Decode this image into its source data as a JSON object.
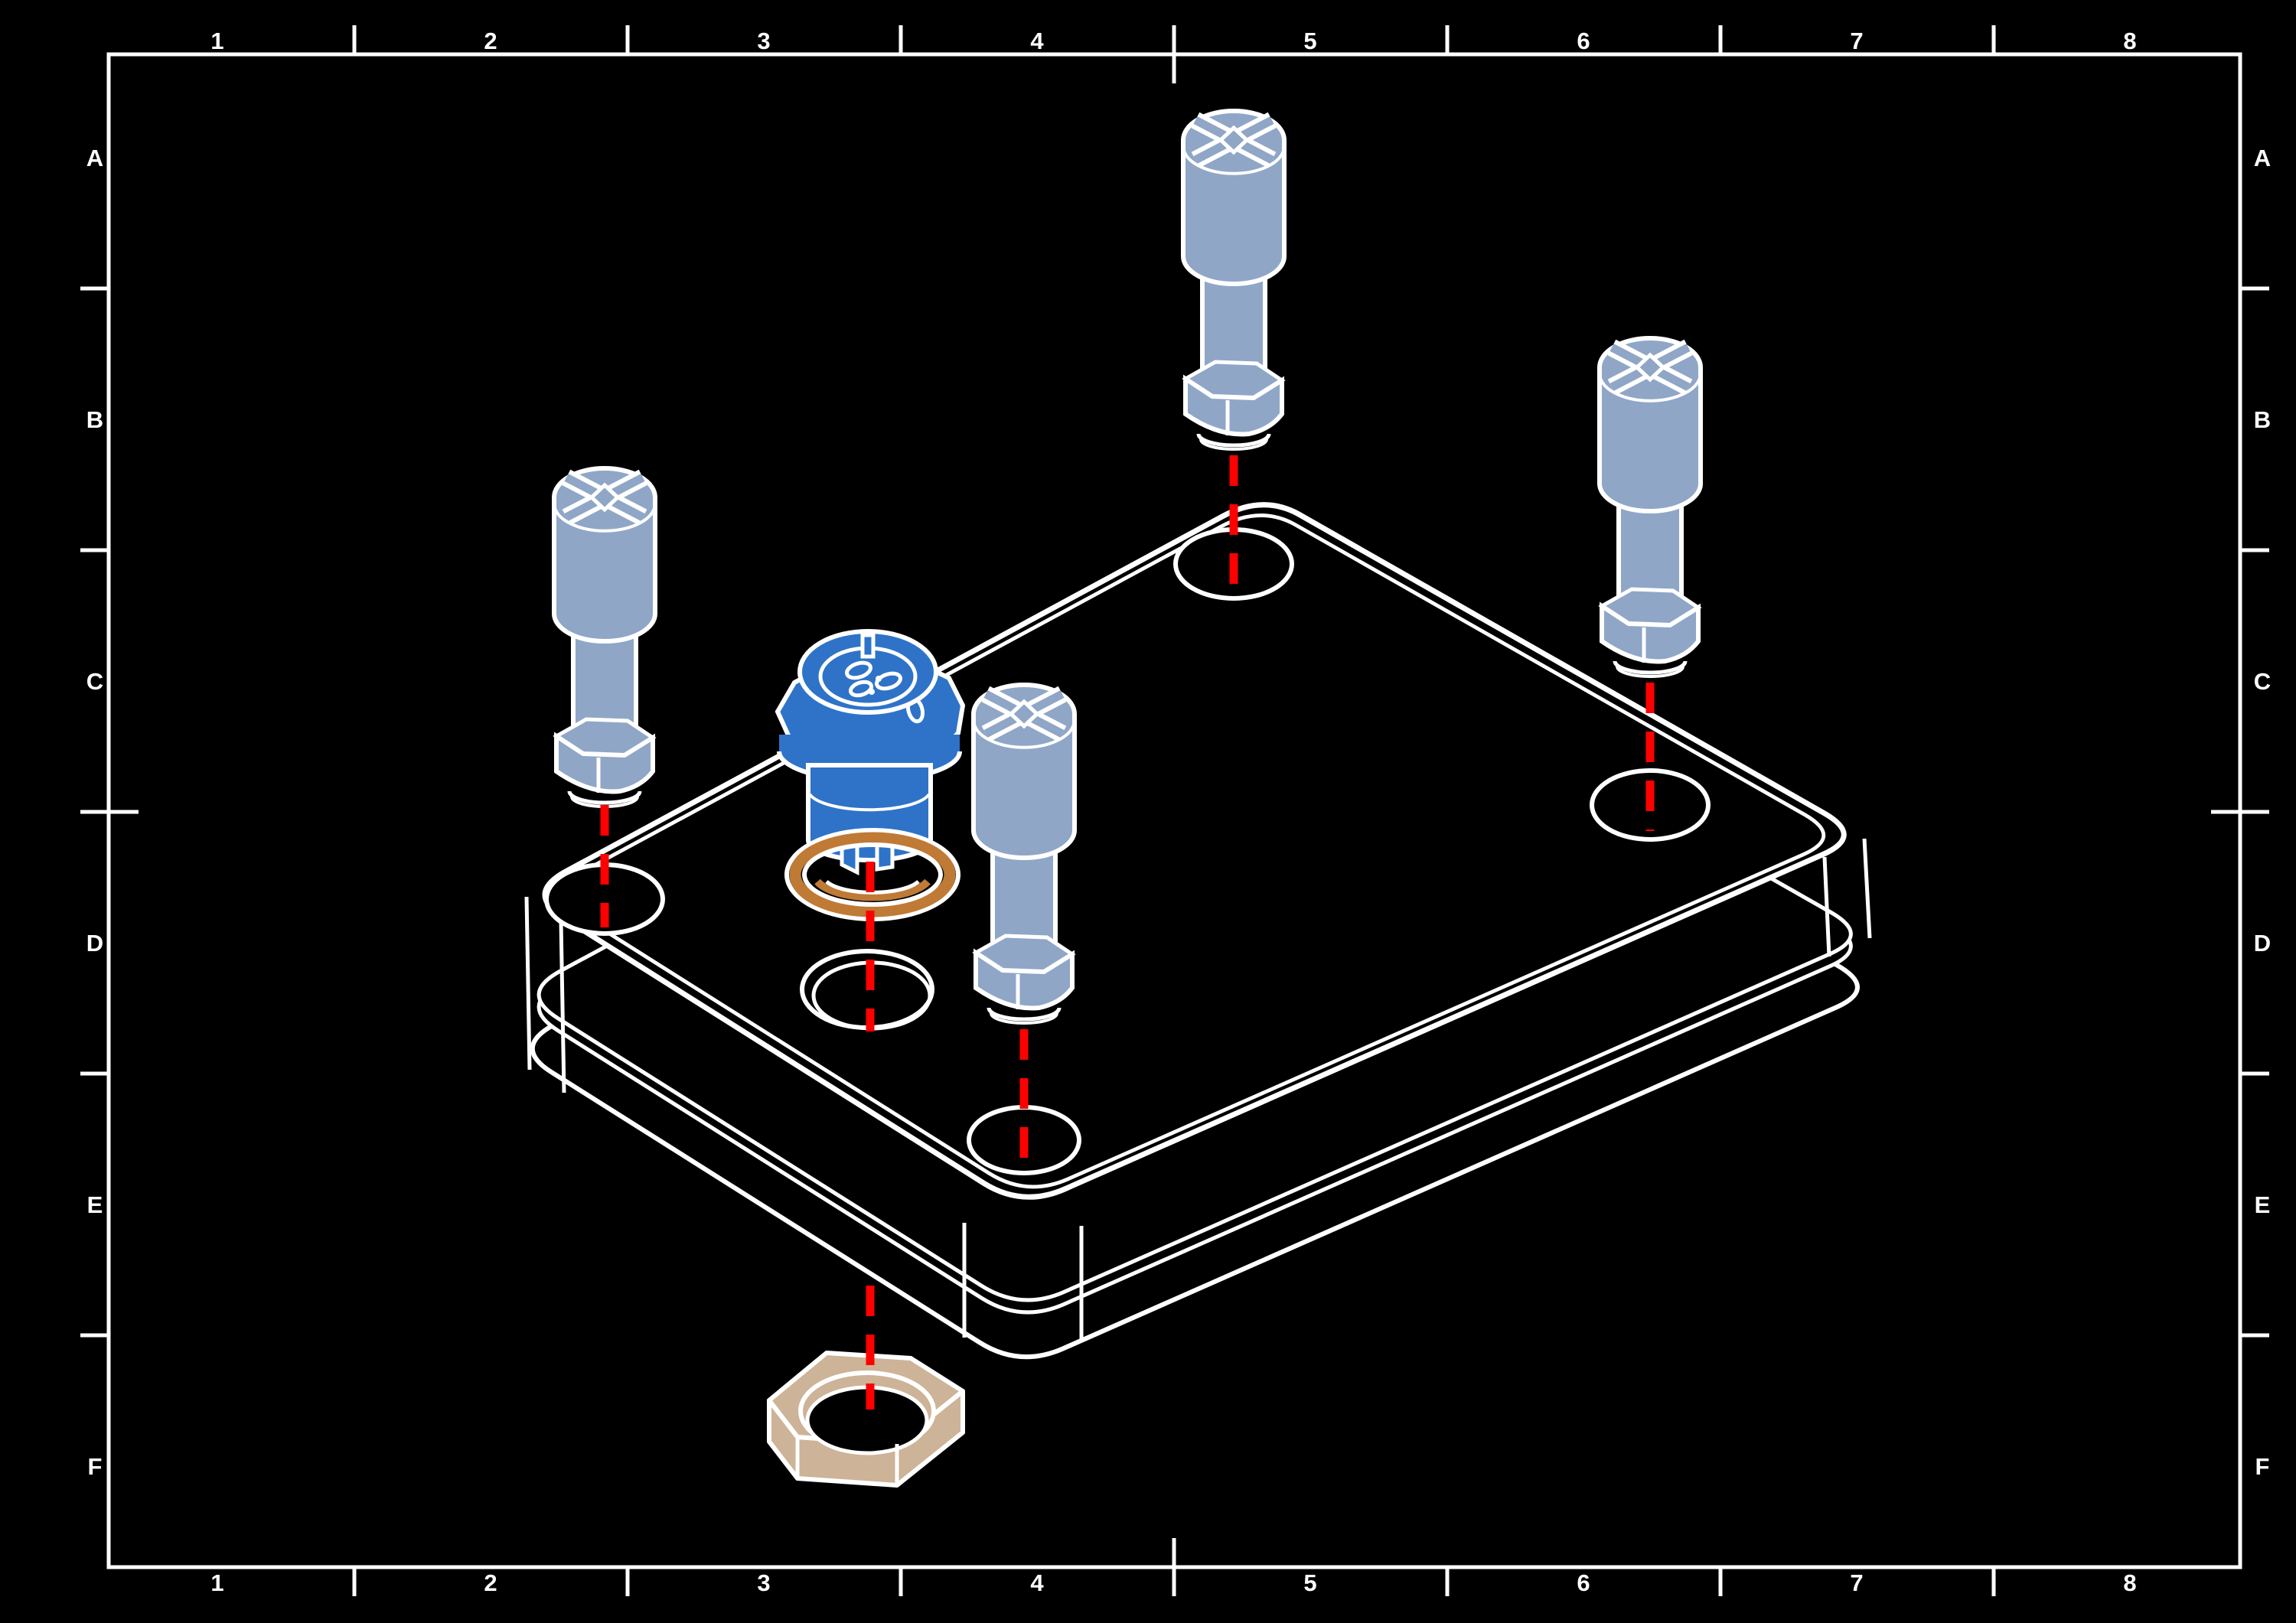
{
  "sheet": {
    "grid_columns": [
      "1",
      "2",
      "3",
      "4",
      "5",
      "6",
      "7",
      "8"
    ],
    "grid_rows": [
      "A",
      "B",
      "C",
      "D",
      "E",
      "F"
    ]
  },
  "colors": {
    "background": "#000000",
    "line_work": "#FFFFFF",
    "centerline": "#FF0000",
    "screw": "#8FA6C7",
    "connector": "#2E73C8",
    "o_ring": "#BF7A35",
    "nut": "#CDB397"
  },
  "parts": {
    "enclosure": "enclosure-base-box",
    "screws": "captive-panel-screw x4",
    "connector": "circular-panel-connector",
    "o_ring": "sealing-o-ring",
    "nut": "panel-hex-nut"
  }
}
